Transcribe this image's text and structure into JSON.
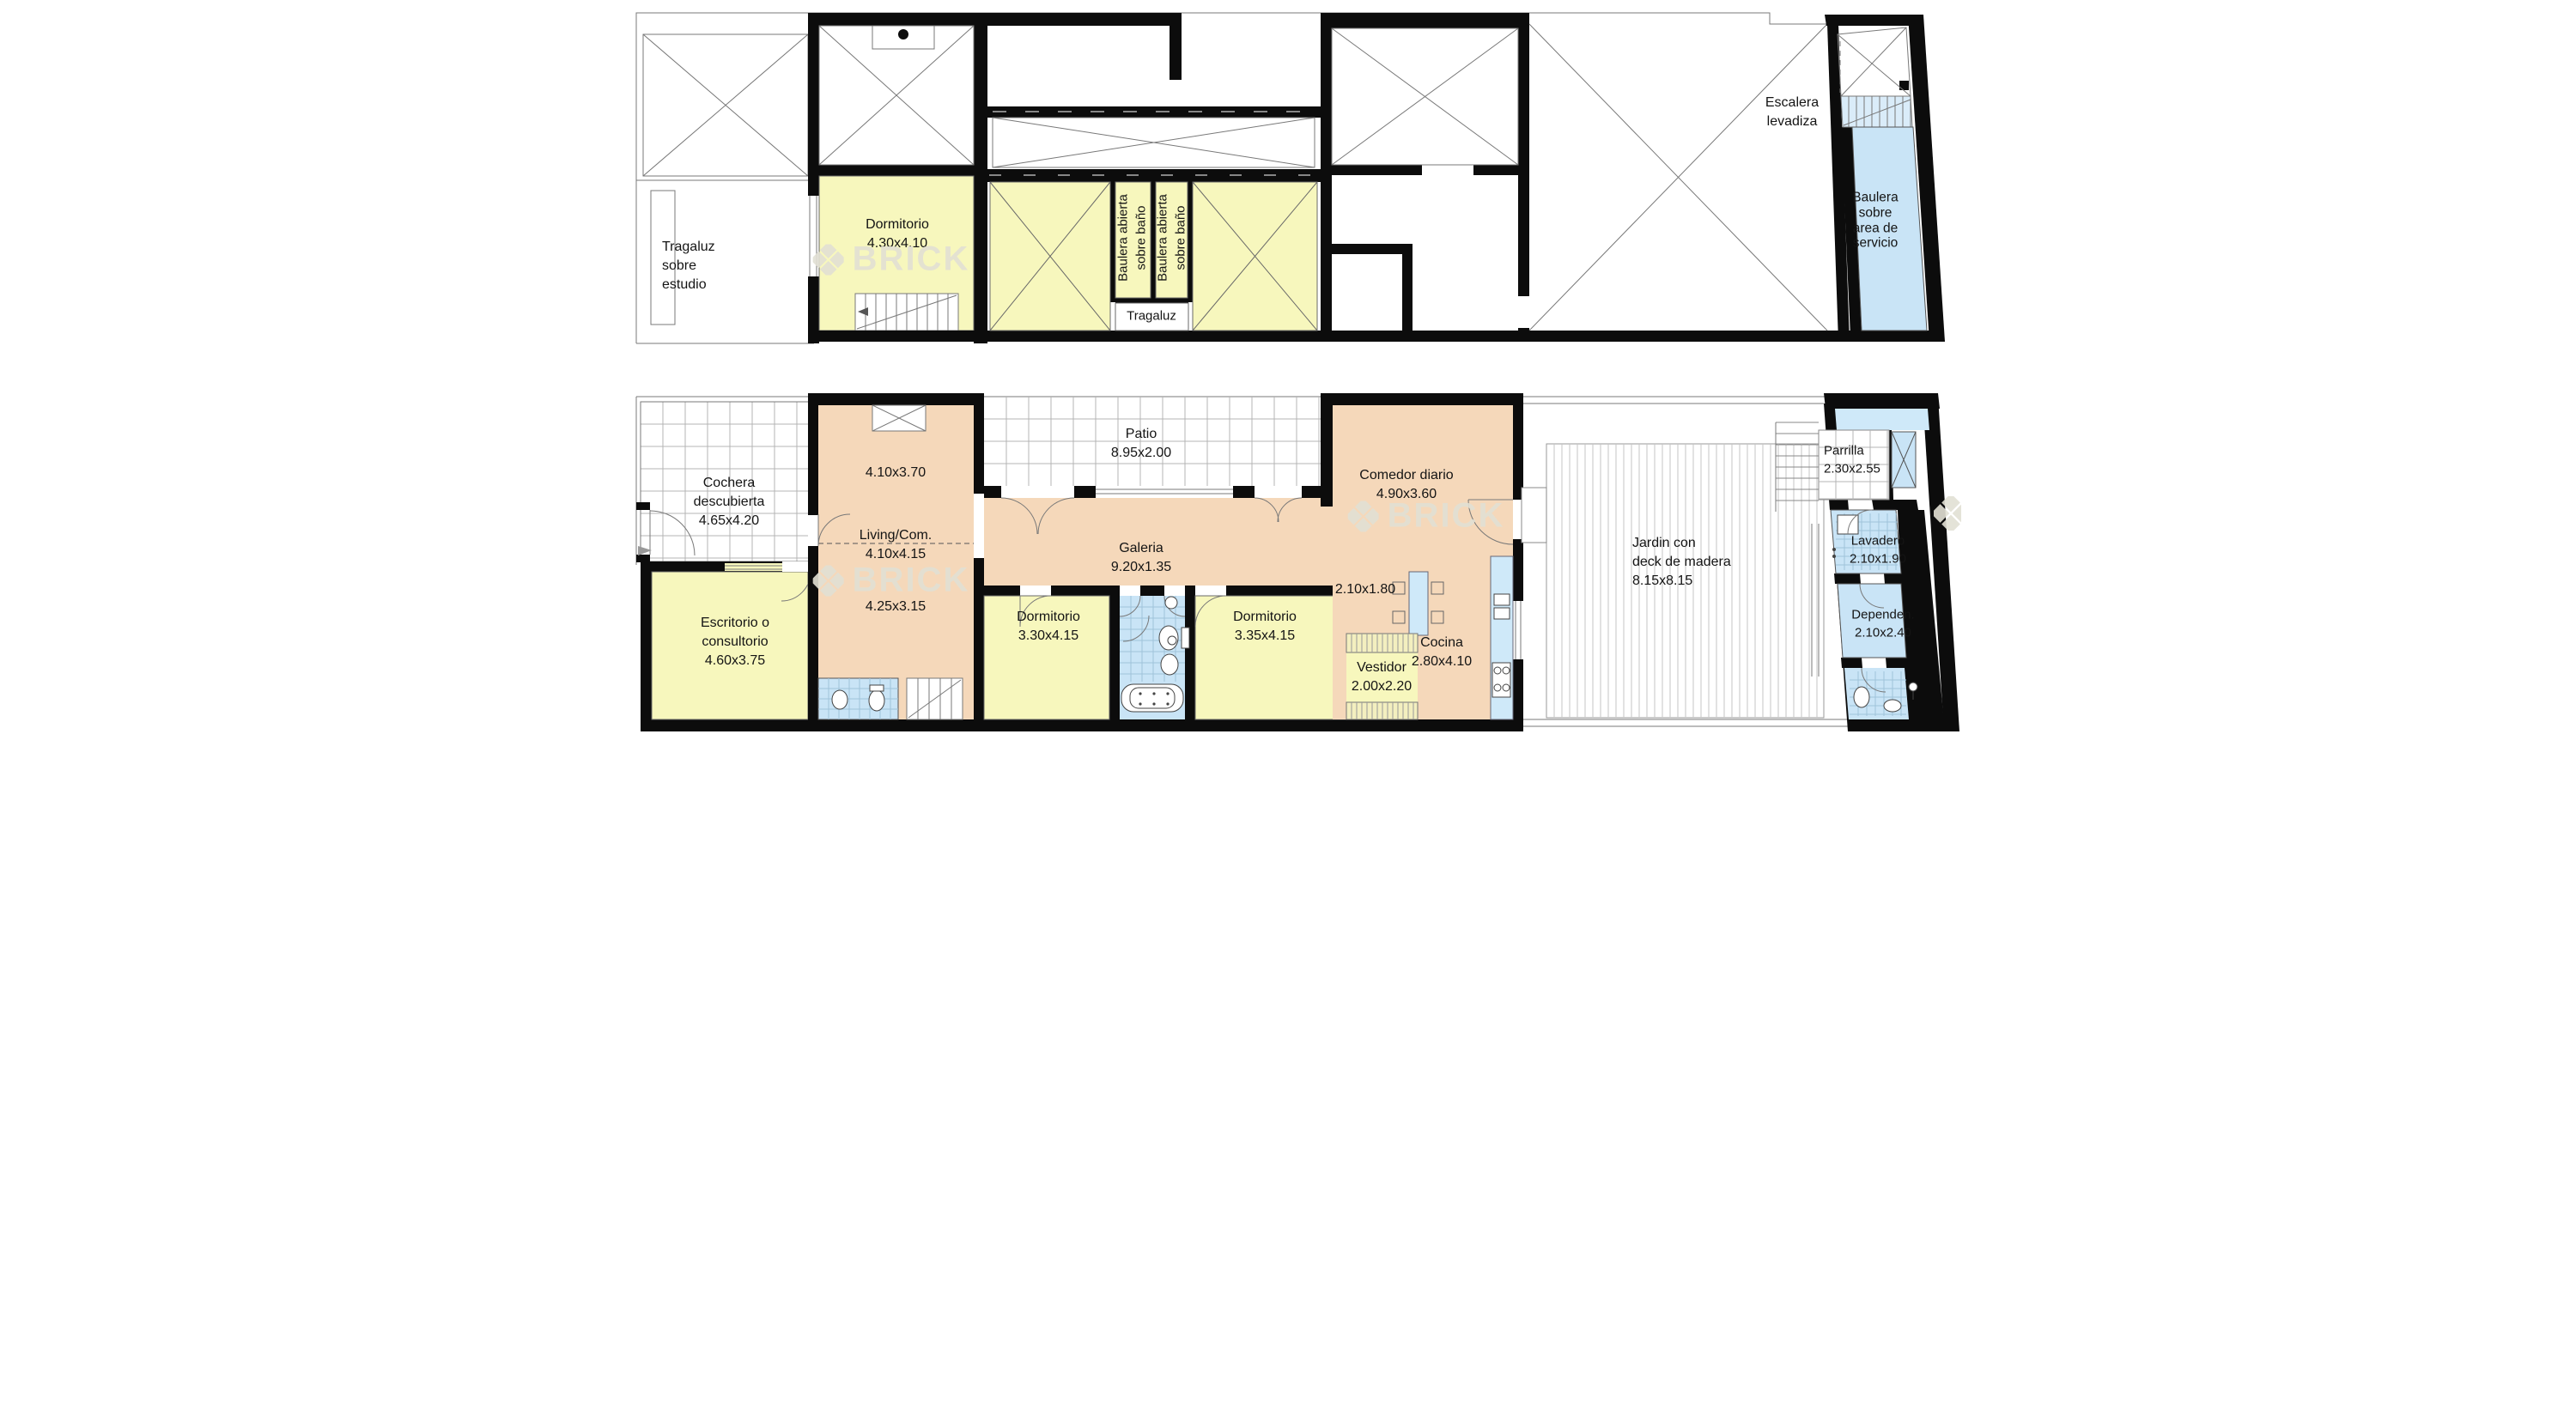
{
  "watermark": {
    "brand": "BRICK",
    "logo_icon": "brick-diamond-logo"
  },
  "colors": {
    "room-yellow": "#f7f7bd",
    "room-peach": "#f5d8ba",
    "room-blue": "#c9e4f6",
    "stair-blue": "#daecf9",
    "fixture-blue": "#cfe9f9",
    "hatch-yellow": "#f3efbf",
    "wall-black": "#0c0c0c",
    "grid-gray": "#b4b4b4",
    "watermark-gray": "#e2e0d4"
  },
  "upper_plan": {
    "rooms": {
      "tragaluz_estudio": {
        "lines": [
          "Tragaluz",
          "sobre",
          "estudio"
        ]
      },
      "dormitorio": {
        "name": "Dormitorio",
        "dims": "4.30x4.10"
      },
      "baulera_abierta": {
        "lines": [
          "Baulera abierta",
          "sobre baño"
        ]
      },
      "tragaluz": {
        "name": "Tragaluz"
      },
      "escalera_levadiza": {
        "lines": [
          "Escalera",
          "levadiza"
        ]
      },
      "baulera_servicio": {
        "lines": [
          "Baulera",
          "sobre",
          "area de",
          "servicio"
        ]
      }
    }
  },
  "lower_plan": {
    "rooms": {
      "cochera": {
        "lines": [
          "Cochera",
          "descubierta",
          "4.65x4.20"
        ]
      },
      "escritorio": {
        "lines": [
          "Escritorio o",
          "consultorio",
          "4.60x3.75"
        ]
      },
      "sala_410": {
        "dims": "4.10x3.70"
      },
      "living": {
        "name": "Living/Com.",
        "dims": "4.10x4.15"
      },
      "sala_425": {
        "dims": "4.25x3.15"
      },
      "patio": {
        "name": "Patio",
        "dims": "8.95x2.00"
      },
      "galeria": {
        "name": "Galeria",
        "dims": "9.20x1.35"
      },
      "dormitorio_1": {
        "name": "Dormitorio",
        "dims": "3.30x4.15"
      },
      "dormitorio_2": {
        "name": "Dormitorio",
        "dims": "3.35x4.15"
      },
      "nook": {
        "dims": "2.10x1.80"
      },
      "vestidor": {
        "name": "Vestidor",
        "dims": "2.00x2.20"
      },
      "comedor": {
        "name": "Comedor diario",
        "dims": "4.90x3.60"
      },
      "cocina": {
        "name": "Cocina",
        "dims": "2.80x4.10"
      },
      "jardin": {
        "lines": [
          "Jardin con",
          "deck de madera",
          "8.15x8.15"
        ]
      },
      "parrilla": {
        "name": "Parrilla",
        "dims": "2.30x2.55"
      },
      "lavadero": {
        "name": "Lavadero",
        "dims": "2.10x1.90"
      },
      "dependencia": {
        "name": "Dependen.",
        "dims": "2.10x2.40"
      }
    }
  }
}
